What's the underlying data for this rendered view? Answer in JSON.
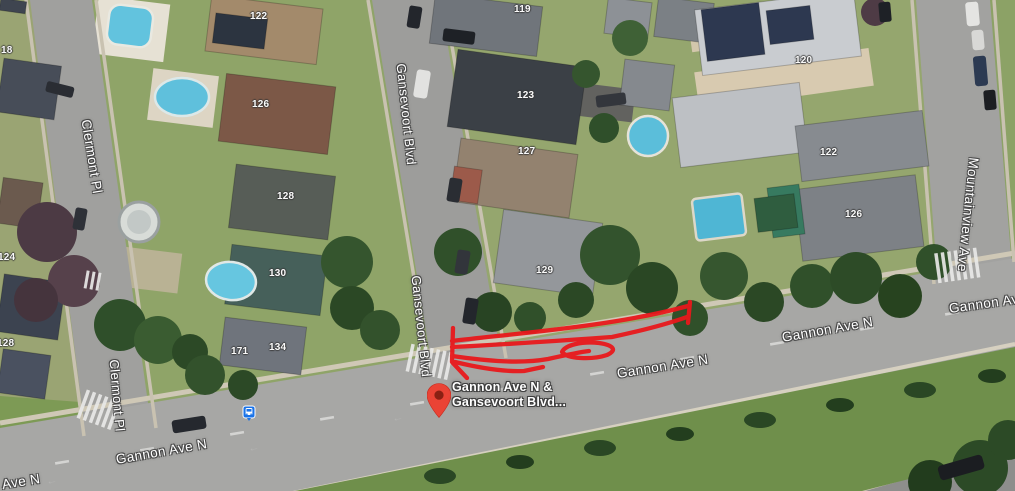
{
  "map": {
    "type": "satellite-aerial-view",
    "streets": [
      {
        "id": "clermont-top",
        "text": "Clermont Pl"
      },
      {
        "id": "clermont-bottom",
        "text": "Clermont Pl"
      },
      {
        "id": "gansevoort-top",
        "text": "Gansevoort Blvd"
      },
      {
        "id": "gansevoort-bottom",
        "text": "Gansevoort Blvd"
      },
      {
        "id": "mountainview",
        "text": "Mountainview Ave"
      },
      {
        "id": "gannon-corner-partial",
        "text": "Ave N"
      },
      {
        "id": "gannon-bottom-left",
        "text": "Gannon Ave N"
      },
      {
        "id": "gannon-center",
        "text": "Gannon Ave N"
      },
      {
        "id": "gannon-right",
        "text": "Gannon Ave N"
      },
      {
        "id": "gannon-far-right",
        "text": "Gannon Ave"
      }
    ],
    "house_numbers": [
      {
        "id": "n18-left-edge",
        "text": "18"
      },
      {
        "id": "n122-left",
        "text": "122"
      },
      {
        "id": "n126-left",
        "text": "126"
      },
      {
        "id": "n128-mid",
        "text": "128"
      },
      {
        "id": "n130",
        "text": "130"
      },
      {
        "id": "n134",
        "text": "134"
      },
      {
        "id": "n171",
        "text": "171"
      },
      {
        "id": "n124-edge",
        "text": "124"
      },
      {
        "id": "n128-edge",
        "text": "128"
      },
      {
        "id": "n119",
        "text": "119"
      },
      {
        "id": "n123",
        "text": "123"
      },
      {
        "id": "n127",
        "text": "127"
      },
      {
        "id": "n129",
        "text": "129"
      },
      {
        "id": "n120",
        "text": "120"
      },
      {
        "id": "n122-right",
        "text": "122"
      },
      {
        "id": "n126-right",
        "text": "126"
      }
    ],
    "marker": {
      "icon": "map-pin-icon",
      "label_line1": "Gannon Ave N &",
      "label_line2": "Gansevoort Blvd...",
      "pin_color": "#EA4335",
      "pin_dot_color": "#8A2013"
    },
    "transit": {
      "icon": "bus-icon",
      "color": "#1A73E8"
    },
    "annotation": {
      "kind": "freehand-scribble",
      "color": "#E8191C"
    }
  }
}
